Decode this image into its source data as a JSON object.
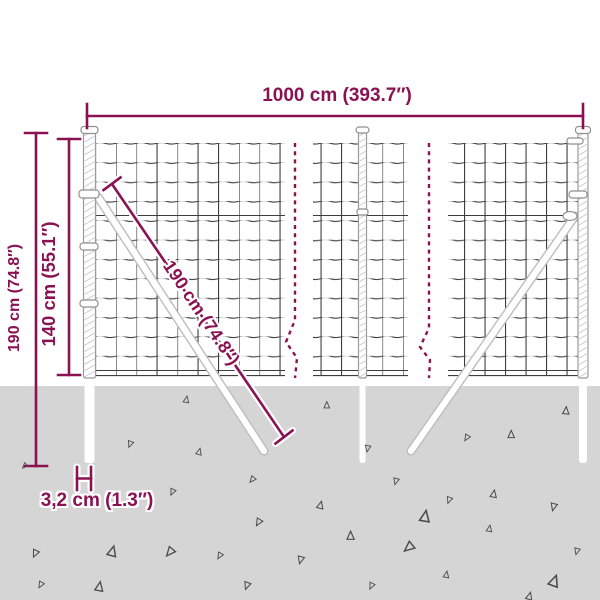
{
  "diagram": {
    "name": "wire-mesh-fence-dimension-diagram",
    "description": "Dimension drawing of a wire mesh fence with three posts, two diagonal ground braces and ground line"
  },
  "labels": {
    "total_length": "1000 cm (393.7″)",
    "total_height": "190 cm (74.8″)",
    "mesh_height": "140 cm (55.1″)",
    "brace_length": "190 cm (74.8″)",
    "post_thickness": "3,2 cm (1.3″)"
  },
  "colors": {
    "dimension": "#8a1253",
    "ground": "#d5d5d5",
    "mesh": "#3d3d3d",
    "post_outline": "#9b9b9b",
    "triangle": "#4b4b4b",
    "background": "#ffffff"
  }
}
